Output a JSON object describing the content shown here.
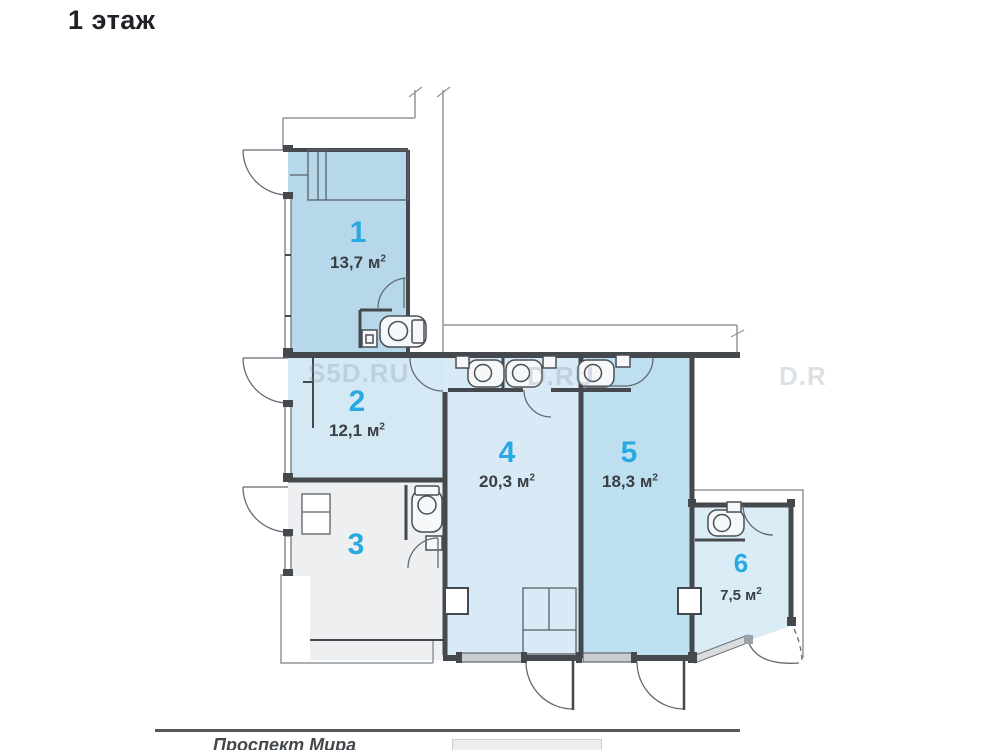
{
  "title": "1 этаж",
  "floor_plan": {
    "rooms": [
      {
        "number": "1",
        "area_text": "13,7 м",
        "area_sup": "2",
        "fill": "#b7d8eb"
      },
      {
        "number": "2",
        "area_text": "12,1 м",
        "area_sup": "2",
        "fill": "#d5e9f4"
      },
      {
        "number": "3",
        "area_text": "",
        "area_sup": "",
        "fill": "#edeff0"
      },
      {
        "number": "4",
        "area_text": "20,3 м",
        "area_sup": "2",
        "fill": "#d7eaf5"
      },
      {
        "number": "5",
        "area_text": "18,3 м",
        "area_sup": "2",
        "fill": "#bedff0"
      },
      {
        "number": "6",
        "area_text": "7,5 м",
        "area_sup": "2",
        "fill": "#daedf7"
      }
    ],
    "street": {
      "label": "Проспект Мира"
    },
    "watermarks": {
      "tile1": "S5D.RU",
      "tile2": "D.RU",
      "tile3": "D.R"
    },
    "colors": {
      "room_number": "#29a9e1",
      "area_text": "#3a4045",
      "wall": "#45494e",
      "outline": "#8f969c",
      "street_line": "#54585c"
    }
  }
}
